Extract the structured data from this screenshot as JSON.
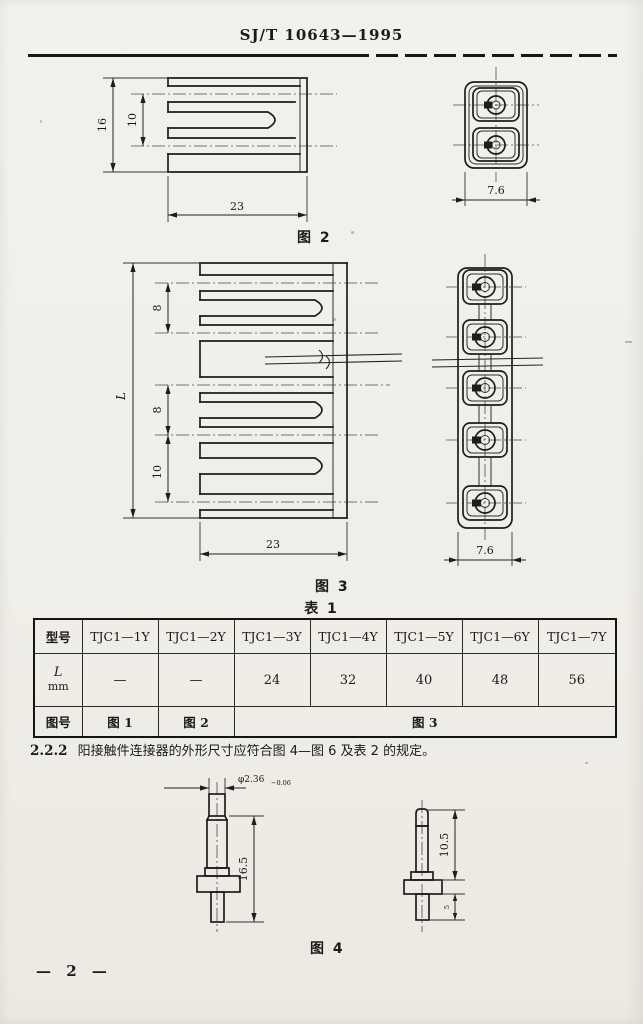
{
  "header": {
    "standard_no": "SJ/T 10643—1995"
  },
  "fig2": {
    "caption": "图 2",
    "dim_height": "16",
    "dim_inner": "10",
    "dim_width": "23",
    "side": {
      "dim_width": "7.6"
    }
  },
  "fig3": {
    "caption": "图 3",
    "dim_length": "L",
    "dim_pitch_top": "8",
    "dim_pitch_mid": "8",
    "dim_pitch_bottom": "10",
    "dim_width": "23",
    "side": {
      "dim_width": "7.6"
    }
  },
  "table1": {
    "title": "表 1",
    "columns": [
      "型号",
      "TJC1—1Y",
      "TJC1—2Y",
      "TJC1—3Y",
      "TJC1—4Y",
      "TJC1—5Y",
      "TJC1—6Y",
      "TJC1—7Y"
    ],
    "row_length": {
      "label": "L",
      "unit": "mm",
      "values": [
        "—",
        "—",
        "24",
        "32",
        "40",
        "48",
        "56"
      ]
    },
    "row_figure": {
      "label": "图号",
      "v1": "图 1",
      "v2": "图 2",
      "v_span": "图 3"
    }
  },
  "clause": {
    "number": "2.2.2",
    "text": "阳接触件连接器的外形尺寸应符合图 4—图 6 及表 2 的规定。"
  },
  "fig4": {
    "caption": "图 4",
    "dim_diameter": "φ2.36",
    "dim_diameter_tol": "−0.06",
    "dim_left_length": "16.5",
    "dim_right_length": "10.5",
    "dim_tail": "5"
  },
  "footer": {
    "page_number": "— 2 —"
  }
}
